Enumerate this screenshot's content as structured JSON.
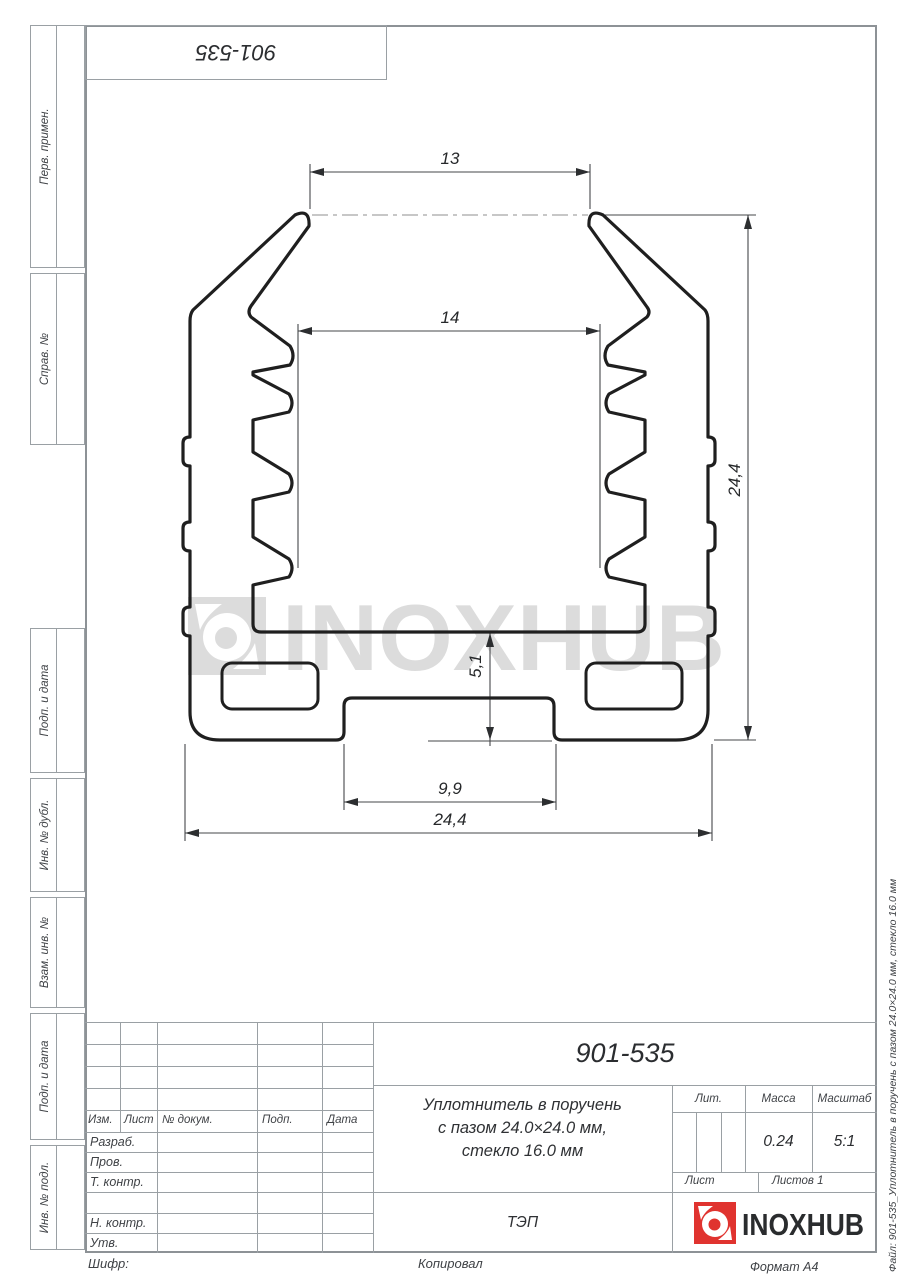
{
  "stamp_top": {
    "doc_number": "901-535"
  },
  "side_strip": {
    "perv_primen": "Перв. примен.",
    "sprav_no": "Справ. №",
    "podp_data_1": "Подп. и дата",
    "inv_dubl": "Инв. № дубл.",
    "vzam_inv": "Взам. инв. №",
    "podp_data_2": "Подп. и дата",
    "inv_podl": "Инв. № подл."
  },
  "side_right": {
    "file_label": "Файл: 901-535_Уплотнитель в поручень с пазом 24.0×24.0 мм, стекло 16.0 мм"
  },
  "dimensions": {
    "top_width": "13",
    "inner_width": "14",
    "height": "24,4",
    "base_depth": "5,1",
    "groove_width": "9,9",
    "total_width": "24,4"
  },
  "watermark": {
    "text": "INOXHUB"
  },
  "title_block": {
    "doc_number": "901-535",
    "title_line1": "Уплотнитель в поручень",
    "title_line2": "с пазом 24.0×24.0 мм,",
    "title_line3": "стекло 16.0 мм",
    "col_izm": "Изм.",
    "col_list": "Лист",
    "col_ndocum": "№ докум.",
    "col_podp": "Подп.",
    "col_data": "Дата",
    "row_razrab": "Разраб.",
    "row_prov": "Пров.",
    "row_tkontr": "Т. контр.",
    "row_nkontr": "Н. контр.",
    "row_utv": "Утв.",
    "lit_label": "Лит.",
    "massa_label": "Масса",
    "masshtab_label": "Масштаб",
    "massa_value": "0.24",
    "masshtab_value": "5:1",
    "list_label": "Лист",
    "listov_label": "Листов 1",
    "tep": "ТЭП",
    "logo_text": "INOXHUB"
  },
  "footer": {
    "shifr": "Шифр:",
    "kopiroval": "Копировал",
    "format": "Формат A4"
  },
  "colors": {
    "logo_red": "#e0332f",
    "line_dark": "#1f1f1f",
    "line_gray": "#9aa0a4",
    "watermark_gray": "#dcdcdc"
  }
}
